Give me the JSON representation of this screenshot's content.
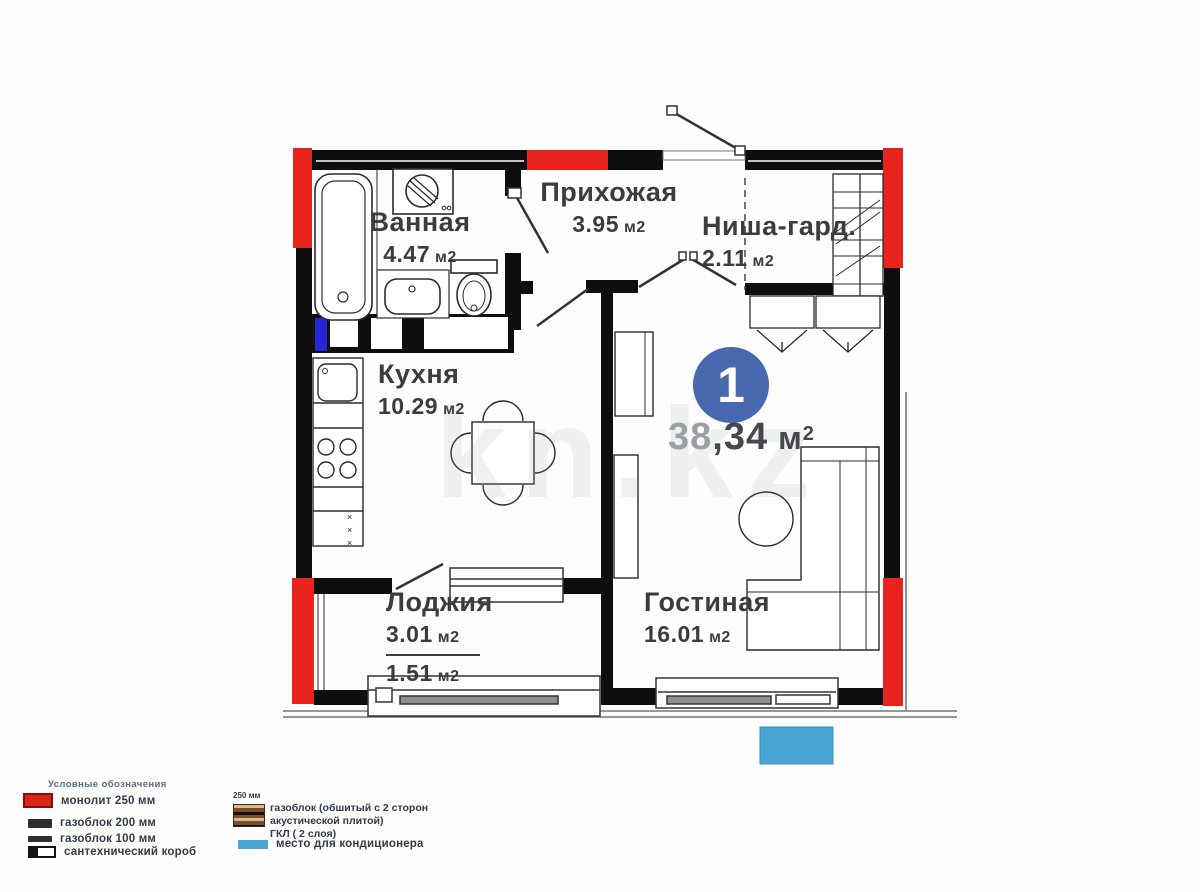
{
  "watermark": "kn.kz",
  "unit": {
    "number": "1",
    "area_lead": "38",
    "area_rest": ",34",
    "area_unit": "м",
    "area_sup": "2"
  },
  "rooms": {
    "bathroom": {
      "name": "Ванная",
      "area": "4.47",
      "unit": "м2"
    },
    "hallway": {
      "name": "Прихожая",
      "area": "3.95",
      "unit": "м2"
    },
    "niche": {
      "name": "Ниша-гард.",
      "area": "2.11",
      "unit": "м2"
    },
    "kitchen": {
      "name": "Кухня",
      "area": "10.29",
      "unit": "м2"
    },
    "living": {
      "name": "Гостиная",
      "area": "16.01",
      "unit": "м2"
    },
    "loggia": {
      "name": "Лоджия",
      "area_full": "3.01",
      "area_reduced": "1.51",
      "unit": "м2"
    }
  },
  "details": {
    "cabinet_marks": "×\n×\n×"
  },
  "legend": {
    "title": "Условные обозначения",
    "monolith": "монолит 250 мм",
    "gasblock200": "газоблок 200 мм",
    "gasblock100": "газоблок 100 мм",
    "sanitary": "сантехнический короб",
    "acoustic_size": "250 мм",
    "acoustic_line1": "газоблок (обшитый с 2 сторон",
    "acoustic_line2": "акустической плитой)",
    "acoustic_line3": "ГКЛ ( 2 слоя)",
    "ac": "место для кондиционера"
  },
  "colors": {
    "monolith_red": "#e8231d",
    "wall_black": "#0e0e0e",
    "badge_blue": "#4868af",
    "ac_blue": "#49a6d6",
    "sanitary_blue": "#2526d6"
  }
}
